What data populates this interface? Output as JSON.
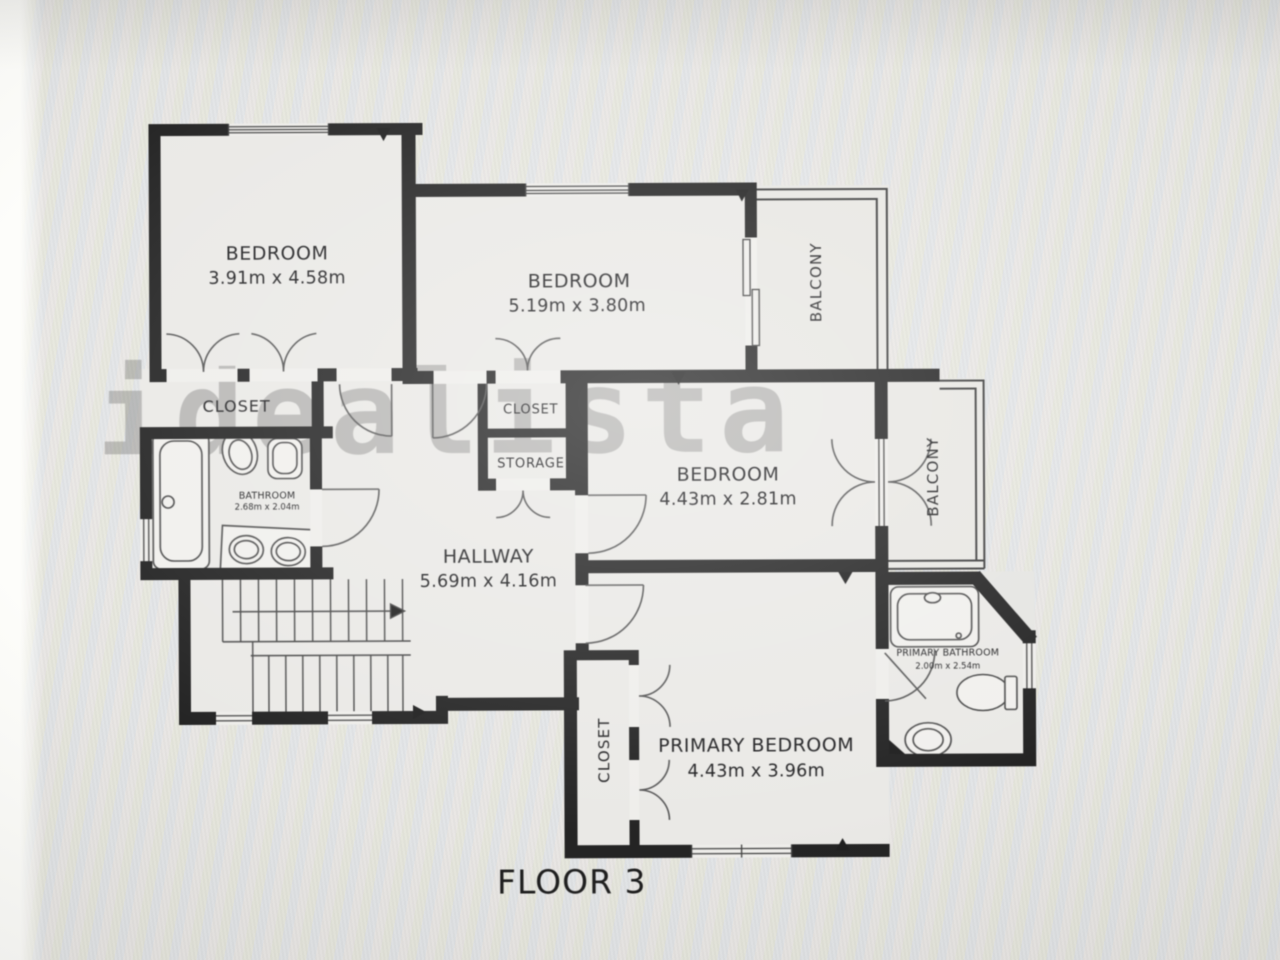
{
  "floor_plan": {
    "title": "FLOOR 3",
    "watermark": "idealista",
    "rooms": {
      "bedroom_top_left": {
        "name": "BEDROOM",
        "dims": "3.91m x 4.58m"
      },
      "bedroom_top_middle": {
        "name": "BEDROOM",
        "dims": "5.19m x 3.80m"
      },
      "bedroom_middle": {
        "name": "BEDROOM",
        "dims": "4.43m x 2.81m"
      },
      "primary_bedroom": {
        "name": "PRIMARY BEDROOM",
        "dims": "4.43m x 3.96m"
      },
      "hallway": {
        "name": "HALLWAY",
        "dims": "5.69m x 4.16m"
      },
      "bathroom": {
        "name": "BATHROOM",
        "dims": "2.68m x 2.04m"
      },
      "primary_bathroom": {
        "name": "PRIMARY BATHROOM",
        "dims": "2.00m x 2.54m"
      },
      "closet_left": {
        "name": "CLOSET"
      },
      "closet_middle": {
        "name": "CLOSET"
      },
      "storage": {
        "name": "STORAGE"
      },
      "closet_primary": {
        "name": "CLOSET"
      },
      "balcony_top": {
        "name": "BALCONY"
      },
      "balcony_right": {
        "name": "BALCONY"
      }
    },
    "colors": {
      "wall": "#212121",
      "floor": "#edece9",
      "background": "#e8e8e5",
      "watermark": "#6f6f6d",
      "label": "#1d1d1f"
    }
  }
}
